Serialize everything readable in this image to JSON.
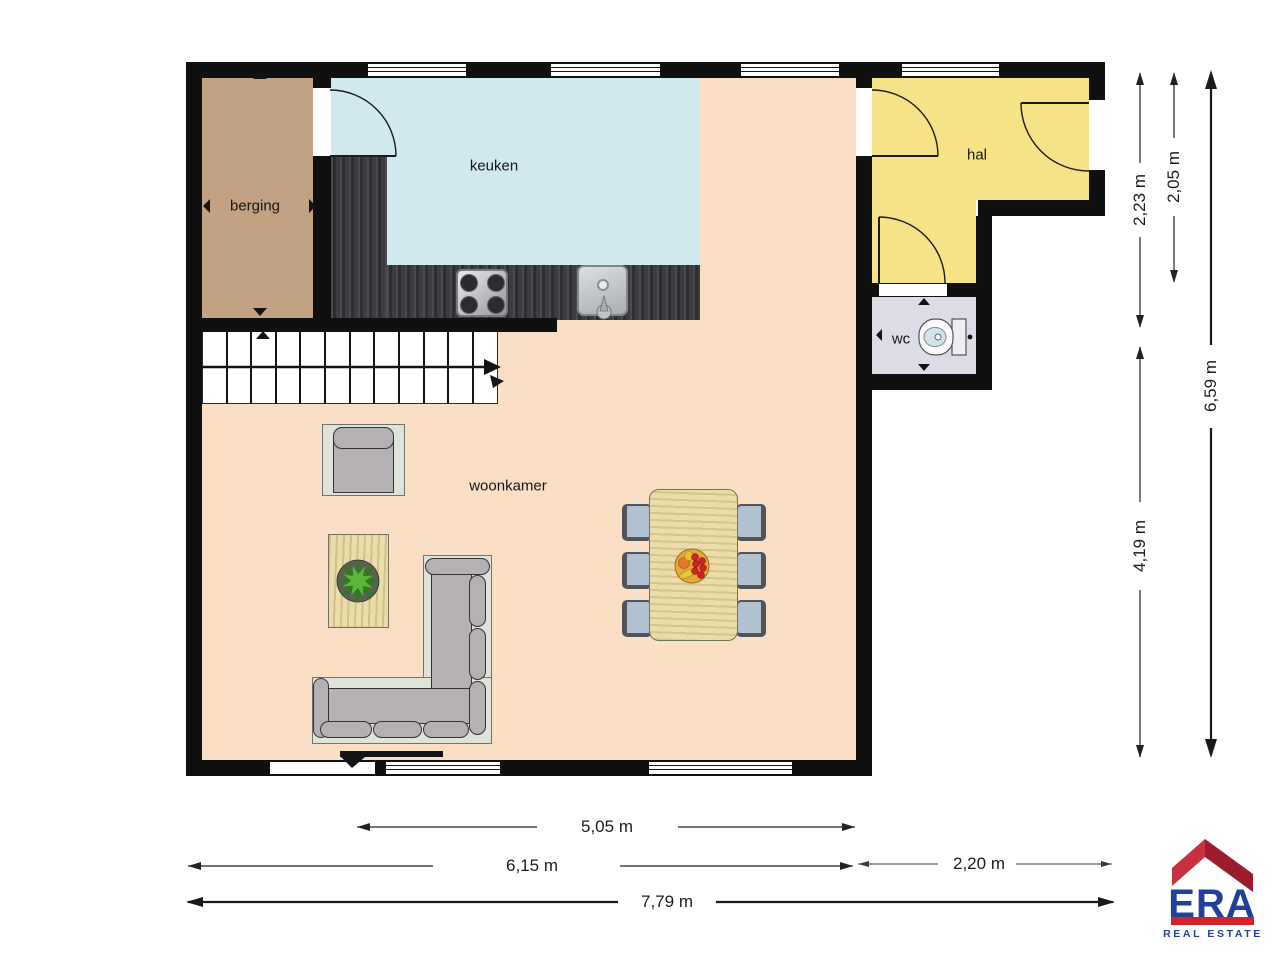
{
  "floorplan": {
    "rooms": [
      {
        "name": "berging",
        "color": "#c2a283"
      },
      {
        "name": "keuken",
        "color": "#d0e9ef"
      },
      {
        "name": "hal",
        "color": "#f6e388"
      },
      {
        "name": "wc",
        "color": "#dcdce6"
      },
      {
        "name": "woonkamer",
        "color": "#fbdfc5"
      }
    ],
    "wall_color": "#101010",
    "dimensions_horizontal": [
      {
        "label": "5,05 m"
      },
      {
        "label": "6,15 m"
      },
      {
        "label": "2,20 m"
      },
      {
        "label": "7,79 m"
      }
    ],
    "dimensions_vertical": [
      {
        "label": "2,23 m"
      },
      {
        "label": "2,05 m"
      },
      {
        "label": "6,59 m"
      },
      {
        "label": "4,19 m"
      }
    ]
  },
  "logo": {
    "brand": "ERA",
    "tagline": "REAL ESTATE",
    "roof_red_light": "#c63040",
    "roof_red_dark": "#9c1c2e",
    "bar_red": "#d2232a",
    "text_blue": "#21409a"
  }
}
